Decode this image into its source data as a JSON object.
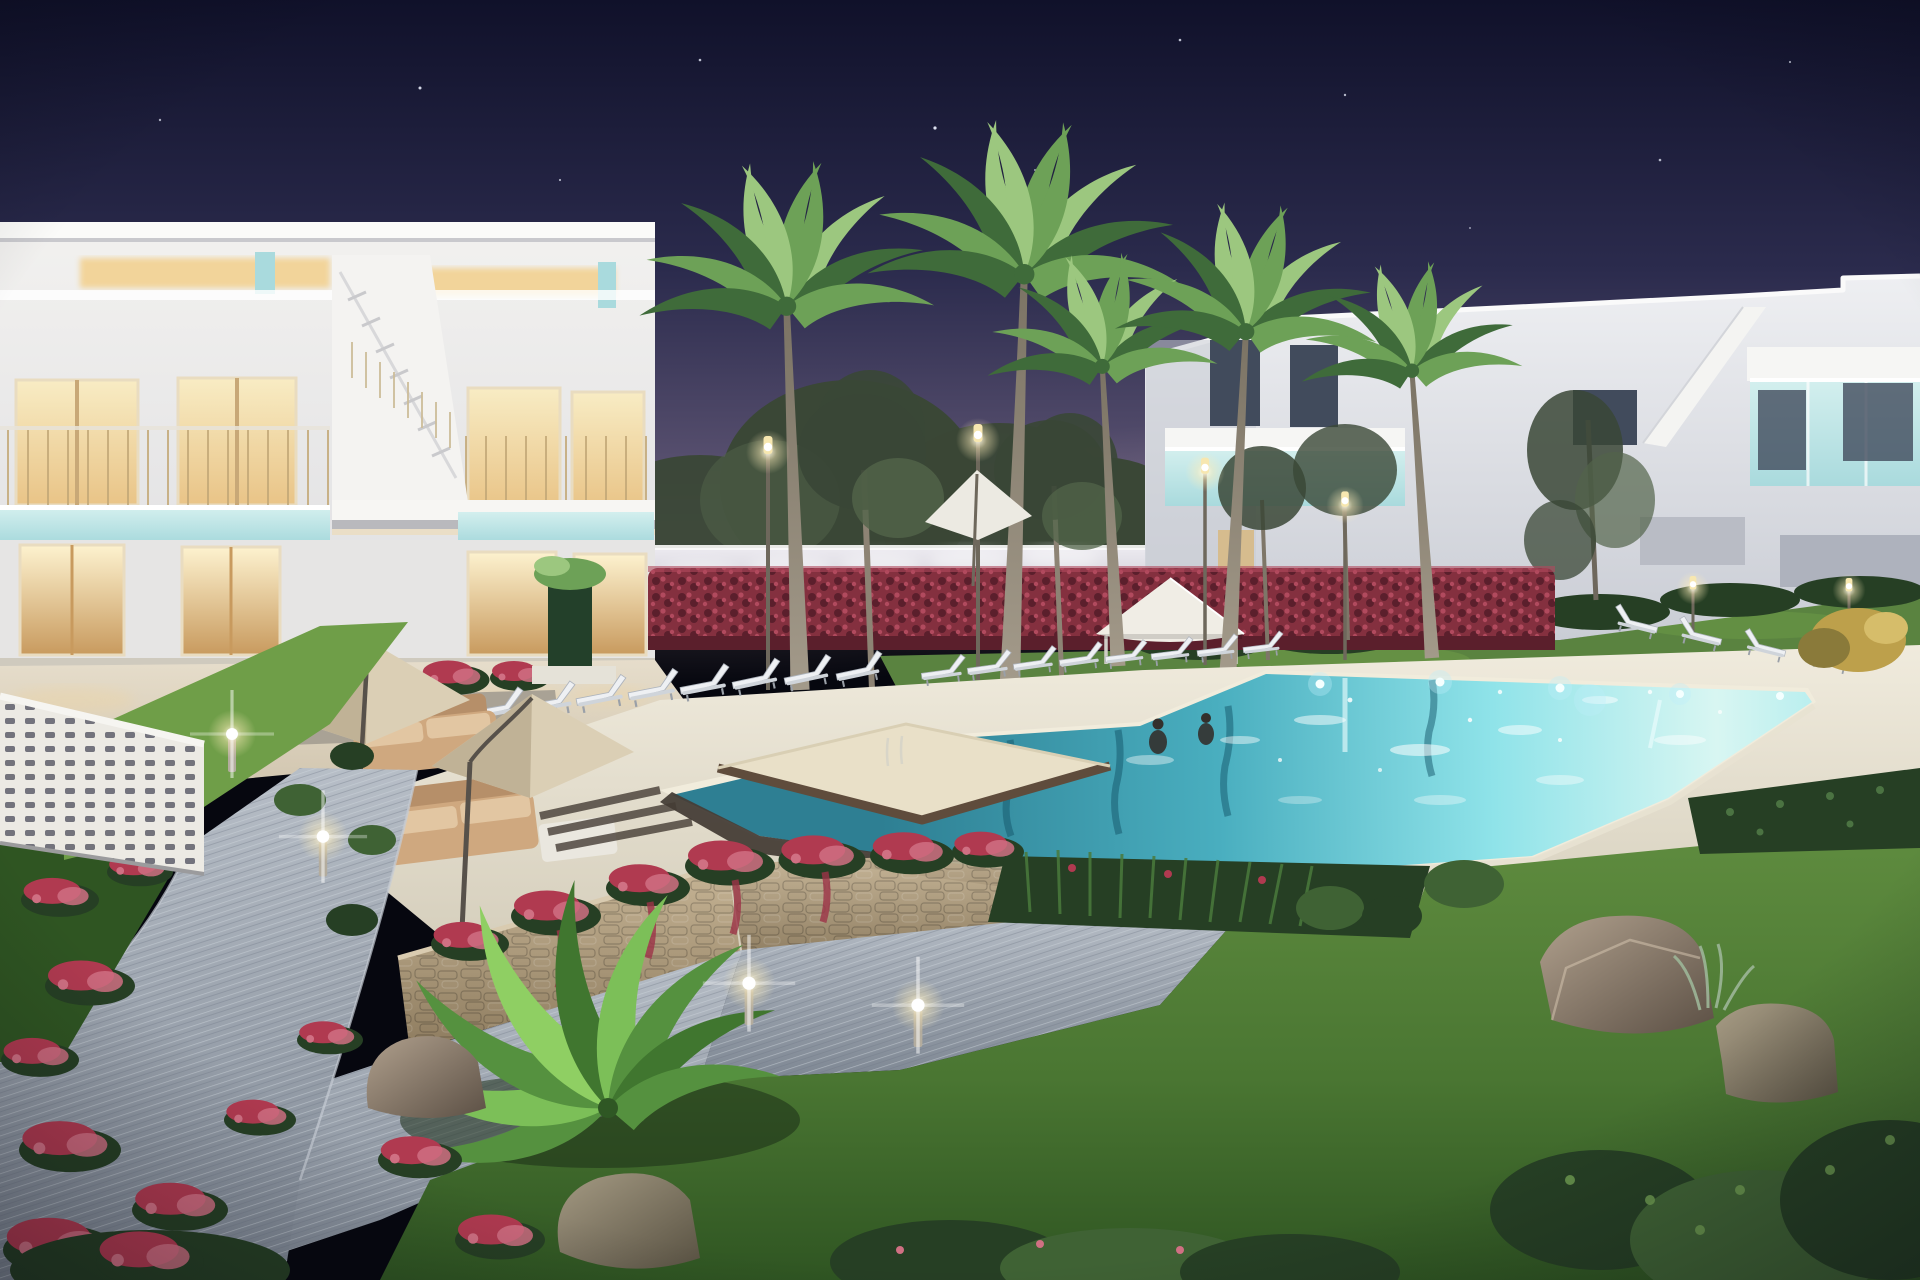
{
  "image": {
    "type": "3d-architectural-render",
    "scene": "Night-time render of a modern white residential complex with illuminated two-storey townhouses, palm trees and a large turquoise communal swimming pool with an island sun platform",
    "time_of_day": "night",
    "elements": [
      "left-townhouse-block",
      "right-townhouse-block",
      "external-staircase",
      "warm-lit-windows",
      "teal-glass-balconies",
      "perimeter-wall",
      "bougainvillea-hedge",
      "palm-trees",
      "pine-trees",
      "street-lamps",
      "swimming-pool",
      "island-sun-platform",
      "sun-loungers",
      "parasols",
      "gazebo",
      "outdoor-sofas",
      "stone-planter-walls",
      "cascading-red-flowers",
      "curved-paved-path",
      "bollard-lights",
      "lawns",
      "rocks",
      "shrubs",
      "decorative-lattice-wall",
      "starry-sky"
    ],
    "palette": {
      "sky_top": "#10112a",
      "sky_mid": "#2b2b4d",
      "sky_low": "#58506f",
      "sky_horizon": "#9b8b9f",
      "star": "#e8ecfa",
      "facade_light": "#f2f1ef",
      "facade_mid": "#dedee1",
      "facade_shadow": "#c6c8cf",
      "roof_cap": "#fbfbf9",
      "warm_glow": "#f2d49a",
      "window_warm": "#e9c487",
      "window_warm_dark": "#c89a5e",
      "curtain": "#e3cc9f",
      "window_dark": "#414b5c",
      "teal_glass": "#a9dadd",
      "teal_glass_hi": "#d3efee",
      "rail_wood": "#c8a877",
      "wall_back": "#d6d5db",
      "wall_back_shadow": "#a9a7b3",
      "hedge_red": "#84303f",
      "hedge_red_hi": "#b14a5e",
      "hedge_red_dark": "#5b1f2c",
      "tree_dark": "#3a4736",
      "tree_mid": "#52644a",
      "trunk": "#91897b",
      "palm_light": "#9cc77f",
      "palm_mid": "#6da157",
      "palm_dark": "#3f6b3a",
      "lamp_warm": "#ffe9ad",
      "lamp_core": "#ffffff",
      "deck_sand": "#ece7d8",
      "deck_sand_dark": "#d2cbb8",
      "pool_deep": "#2e7f93",
      "pool_mid": "#5fc3d2",
      "pool_light": "#aef0f2",
      "pool_pale": "#d8f6f2",
      "pool_edge_dark": "#463e37",
      "coping": "#f1ecdc",
      "platform_sand": "#e9e0c8",
      "platform_wood": "#5f4c3c",
      "lawn_back": "#5a8340",
      "lawn_mid": "#4a7632",
      "lawn_dark": "#2f5522",
      "lawn_bright": "#6f9e48",
      "path_light": "#b7bec7",
      "path_mid": "#9aa3af",
      "path_dark": "#7e8793",
      "stone_light": "#c7b596",
      "stone_mid": "#ab9878",
      "stone_dark": "#8d7b5e",
      "flower_red": "#b03a50",
      "flower_pink": "#d07083",
      "bush_dark": "#263f24",
      "bush_mid": "#3f6234",
      "bush_silver": "#9db698",
      "shrub_gold": "#bda04b",
      "rock_light": "#b0a08d",
      "rock_mid": "#847567",
      "rock_dark": "#5c5045",
      "sofa": "#cfa87f",
      "sofa_dark": "#b68f69",
      "sofa_hi": "#e2c6a2",
      "parasol": "#dbcfb5",
      "parasol_dark": "#c0b296",
      "gazebo": "#f0ede5",
      "terrace_pav": "#e0d6c5"
    }
  }
}
